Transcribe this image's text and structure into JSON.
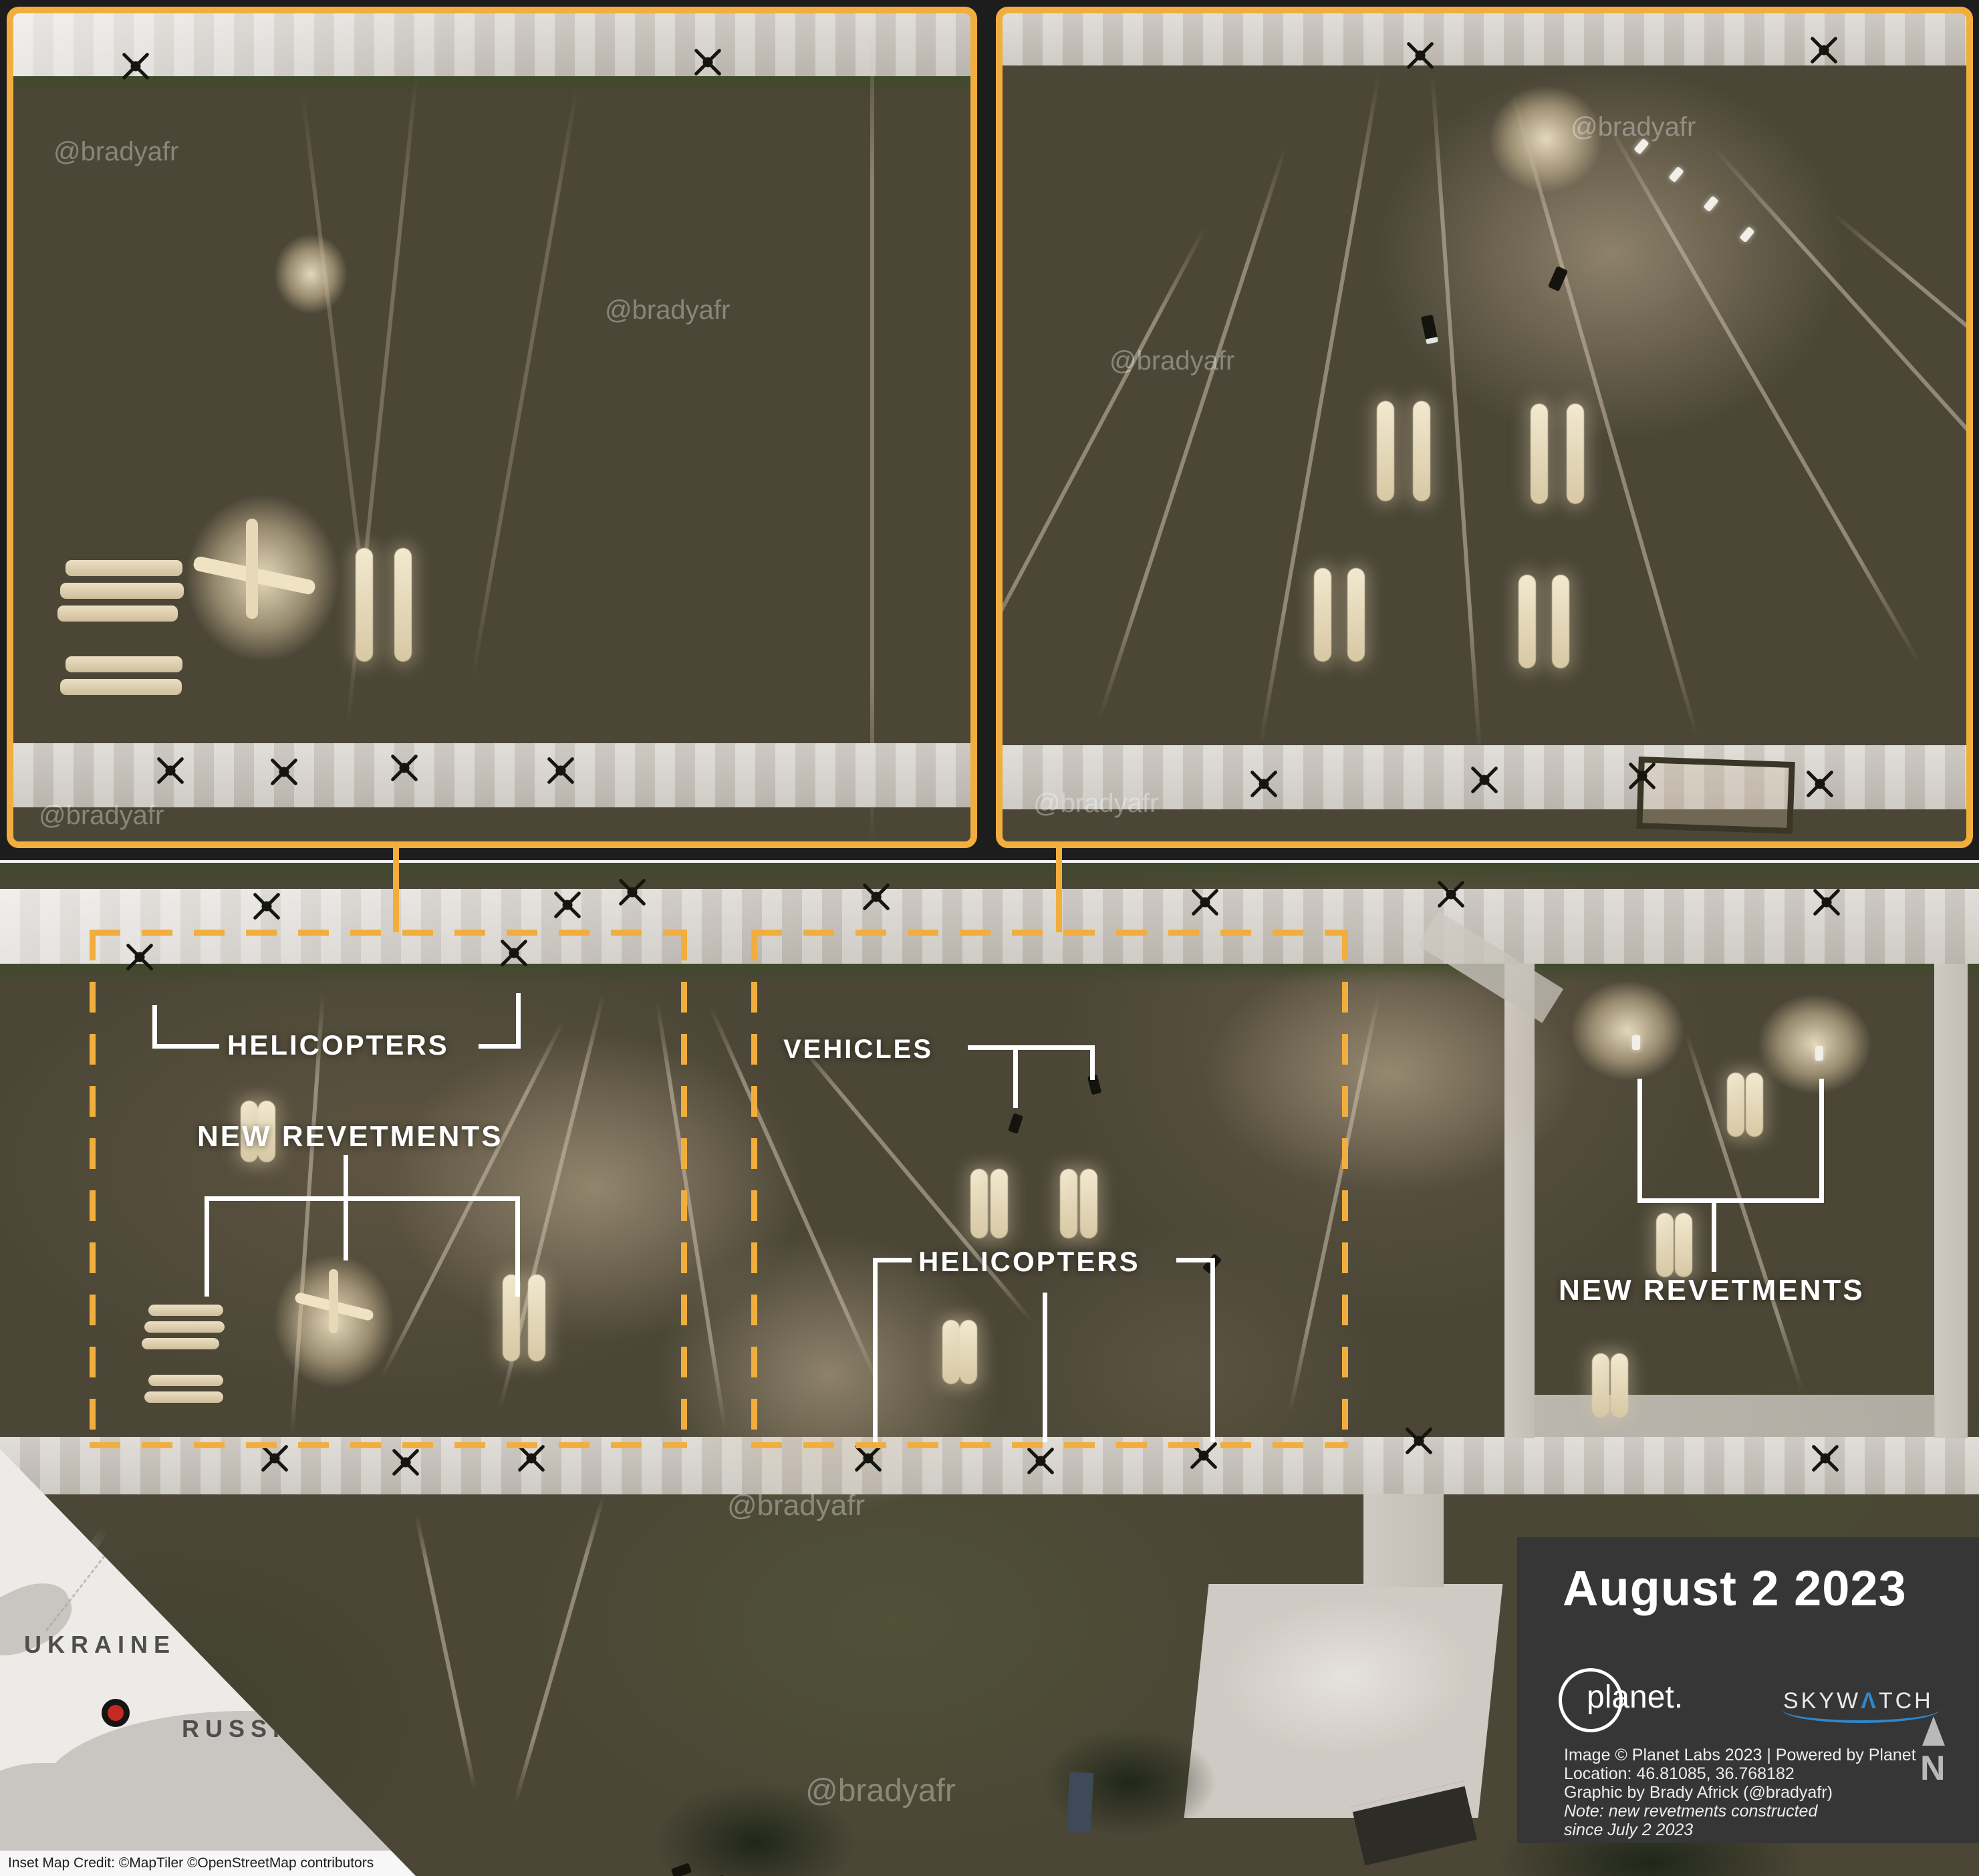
{
  "accent_color": "#F1AE3E",
  "watermark": {
    "handle": "@bradyafr"
  },
  "annotations": {
    "helicopters_left": "HELICOPTERS",
    "new_revetments_left": "NEW REVETMENTS",
    "vehicles": "VEHICLES",
    "helicopters_center": "HELICOPTERS",
    "new_revetments_right": "NEW REVETMENTS"
  },
  "inset_map": {
    "country_1": "UKRAINE",
    "country_2": "RUSSIA",
    "credit": "Inset Map Credit: ©MapTiler ©OpenStreetMap contributors",
    "marker_color": "#C32A23"
  },
  "info_panel": {
    "date": "August 2 2023",
    "planet_logo": "planet.",
    "skywatch_pre": "SKYW",
    "skywatch_a": "Λ",
    "skywatch_post": "TCH",
    "credit_line_1": "Image © Planet Labs 2023 | Powered by Planet",
    "credit_line_2": "Location: 46.81085, 36.768182",
    "credit_line_3": "Graphic by Brady Africk (@bradyafr)",
    "note_line_1": "Note: new revetments constructed",
    "note_line_2": "since July 2 2023",
    "north_label": "N",
    "background": "#363636",
    "skywatch_blue": "#2F87C8"
  }
}
